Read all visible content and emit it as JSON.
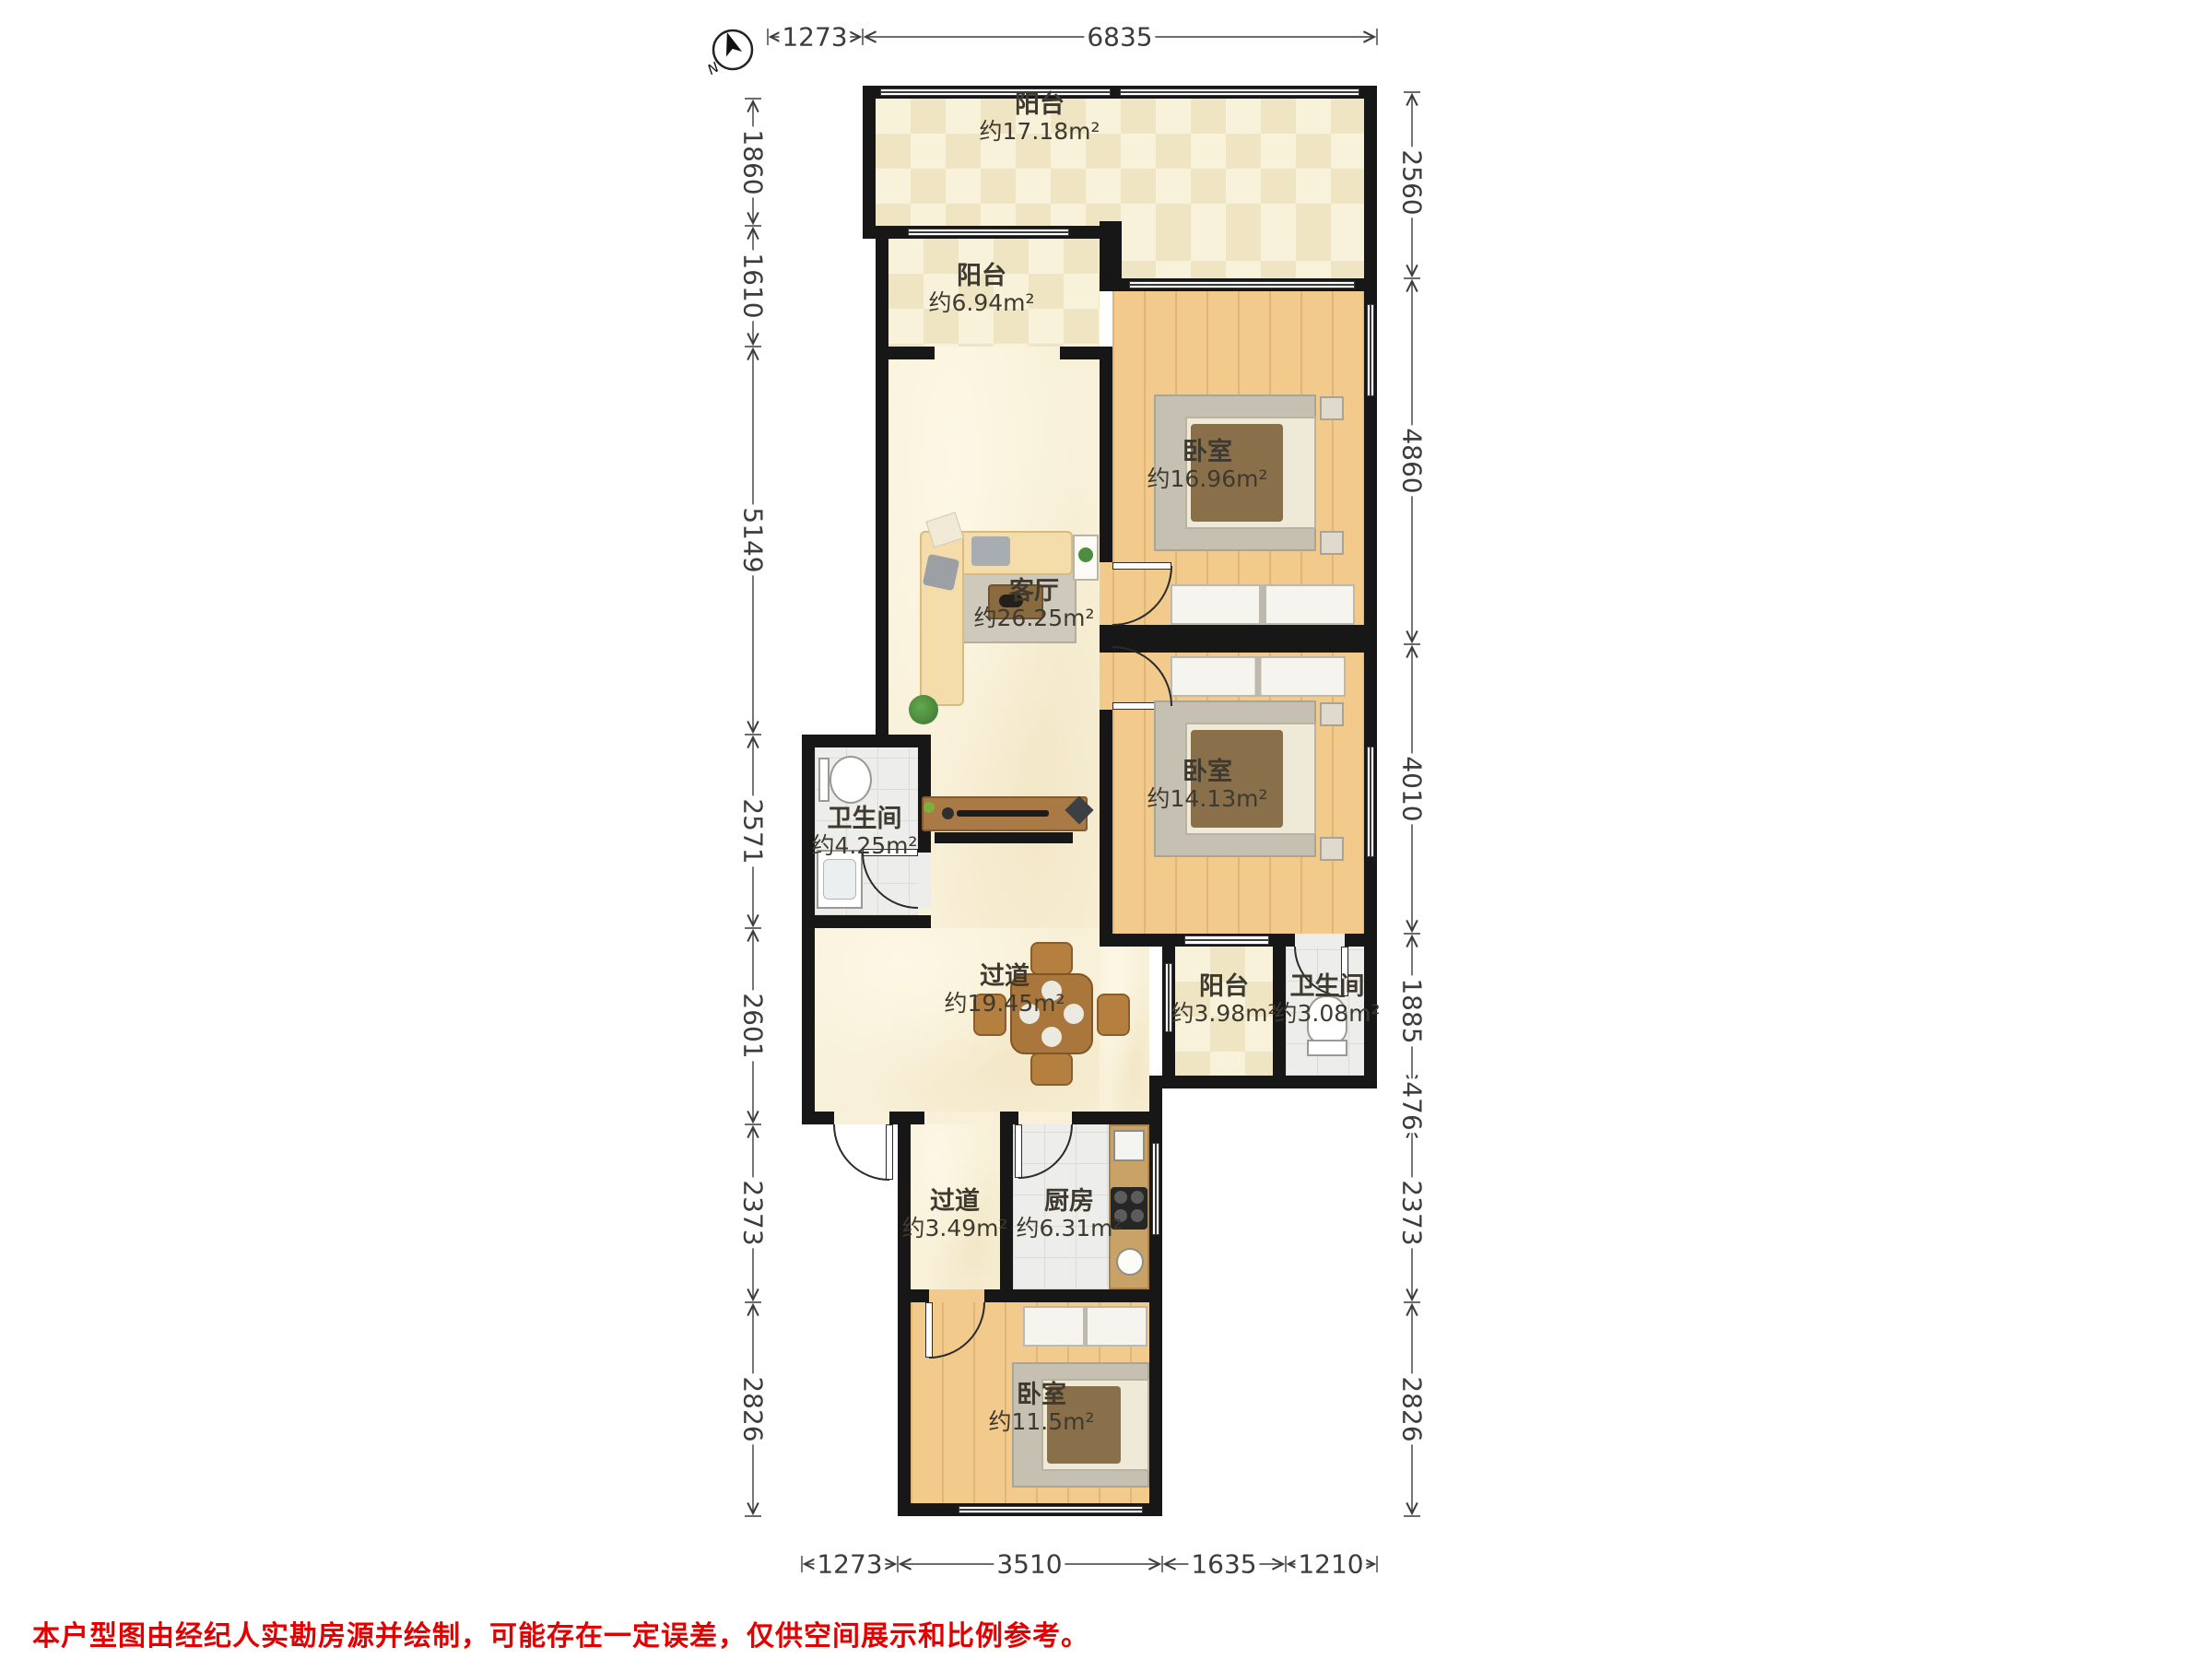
{
  "title": "户型图",
  "compass": {
    "label": "N"
  },
  "rooms": [
    {
      "id": "balcony-top",
      "name": "阳台",
      "area": "约17.18m²"
    },
    {
      "id": "balcony-2",
      "name": "阳台",
      "area": "约6.94m²"
    },
    {
      "id": "bedroom-1",
      "name": "卧室",
      "area": "约16.96m²"
    },
    {
      "id": "living-room",
      "name": "客厅",
      "area": "约26.25m²"
    },
    {
      "id": "bedroom-2",
      "name": "卧室",
      "area": "约14.13m²"
    },
    {
      "id": "bathroom-1",
      "name": "卫生间",
      "area": "约4.25m²"
    },
    {
      "id": "hallway-1",
      "name": "过道",
      "area": "约19.45m²"
    },
    {
      "id": "balcony-3",
      "name": "阳台",
      "area": "约3.98m²"
    },
    {
      "id": "bathroom-2",
      "name": "卫生间",
      "area": "约3.08m²"
    },
    {
      "id": "hallway-2",
      "name": "过道",
      "area": "约3.49m²"
    },
    {
      "id": "kitchen",
      "name": "厨房",
      "area": "约6.31m²"
    },
    {
      "id": "bedroom-3",
      "name": "卧室",
      "area": "约11.5m²"
    }
  ],
  "dims": {
    "top": [
      "1273",
      "6835"
    ],
    "bottom": [
      "1273",
      "3510",
      "1635",
      "1210"
    ],
    "left": [
      "1860",
      "1610",
      "5149",
      "2571",
      "2601",
      "2373",
      "2826"
    ],
    "right": [
      "2560",
      "4860",
      "4010",
      "1885",
      "476",
      "2373",
      "2826"
    ]
  },
  "disclaimer": "本户型图由经纪人实勘房源并绘制，可能存在一定误差，仅供空间展示和比例参考。",
  "colors": {
    "wall": "#171717",
    "dimText": "#3c3c3c",
    "disclaimer": "#e30000",
    "wood": "#f1ca8c",
    "marble": "#f8f0d8",
    "tile": "#ededeb",
    "checker": "#efe5c3",
    "counter": "#c9a268",
    "bedDark": "#8a6f4b",
    "rug": "#c6c0b2",
    "plant": "#4e8c3f"
  }
}
